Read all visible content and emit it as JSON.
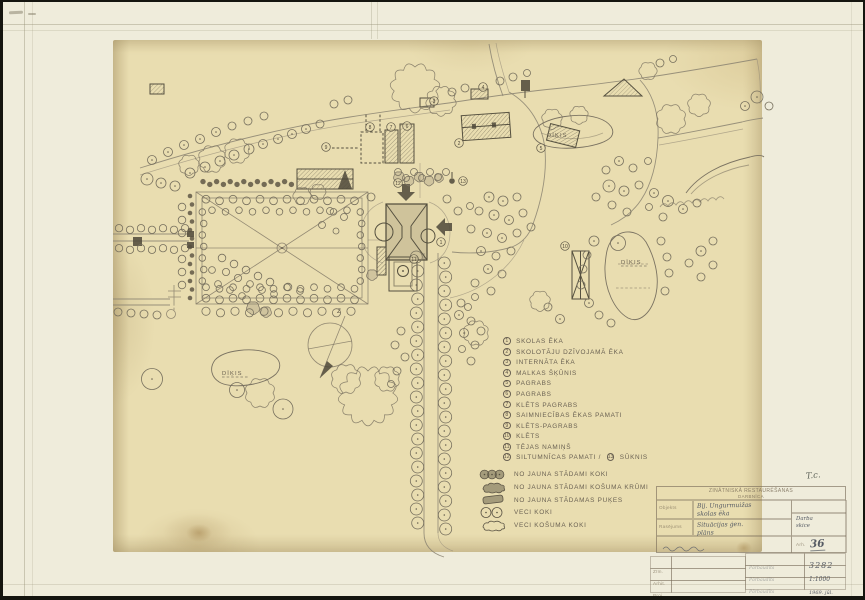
{
  "plan_labels": {
    "pond": "DĪĶIS",
    "north": "Z"
  },
  "legend": {
    "items": [
      {
        "num": "1",
        "label": "SKOLAS ĒKA"
      },
      {
        "num": "2",
        "label": "SKOLOTĀJU DZĪVOJAMĀ ĒKA"
      },
      {
        "num": "3",
        "label": "INTERNĀTA ĒKA"
      },
      {
        "num": "4",
        "label": "MALKAS ŠĶŪNIS"
      },
      {
        "num": "5",
        "label": "PAGRABS"
      },
      {
        "num": "6",
        "label": "PAGRABS"
      },
      {
        "num": "7",
        "label": "KLĒTS PAGRABS"
      },
      {
        "num": "8",
        "label": "SAIMNIECĪBAS ĒKAS PAMATI"
      },
      {
        "num": "9",
        "label": "KLĒTS-PAGRABS"
      },
      {
        "num": "10",
        "label": "KLĒTS"
      },
      {
        "num": "11",
        "label": "TĒJAS NAMIŅŠ"
      },
      {
        "num": "12",
        "label": "SILTUMNĪCAS PAMATI /"
      },
      {
        "num": "13",
        "label": "SŪKNIS"
      }
    ],
    "symbols": [
      {
        "label": "NO JAUNA STĀDAMI KOKI"
      },
      {
        "label": "NO JAUNA STĀDAMI KOŠUMA KRŪMI"
      },
      {
        "label": "NO JAUNA STĀDAMAS PUĶES"
      },
      {
        "label": "VECI KOKI"
      },
      {
        "label": "VECI KOŠUMA KOKI"
      }
    ]
  },
  "stamp": {
    "corner_note": "T.c.",
    "org_line1": "ZINĀTNISKĀ RESTAURĒŠANAS",
    "org_line2": "DARBNĪCA",
    "object_label": "Objekts",
    "object_line1": "Bij. Ungurmuižas",
    "object_line2": "skolas ēka",
    "drawing_label": "Rasējums",
    "drawing_line1": "Situācijas ģen.",
    "drawing_line2": "plāns",
    "note_line1": "Darba",
    "note_line2": "skice",
    "arh_label": "Arh.",
    "sheet_no": "36",
    "file_no": "3282",
    "scale": "1:1000",
    "date": "1969. jūl.",
    "checked": "Pārbaudīts",
    "sig_rows": [
      "Zīm.",
      "Arhit.",
      "Proj."
    ]
  }
}
